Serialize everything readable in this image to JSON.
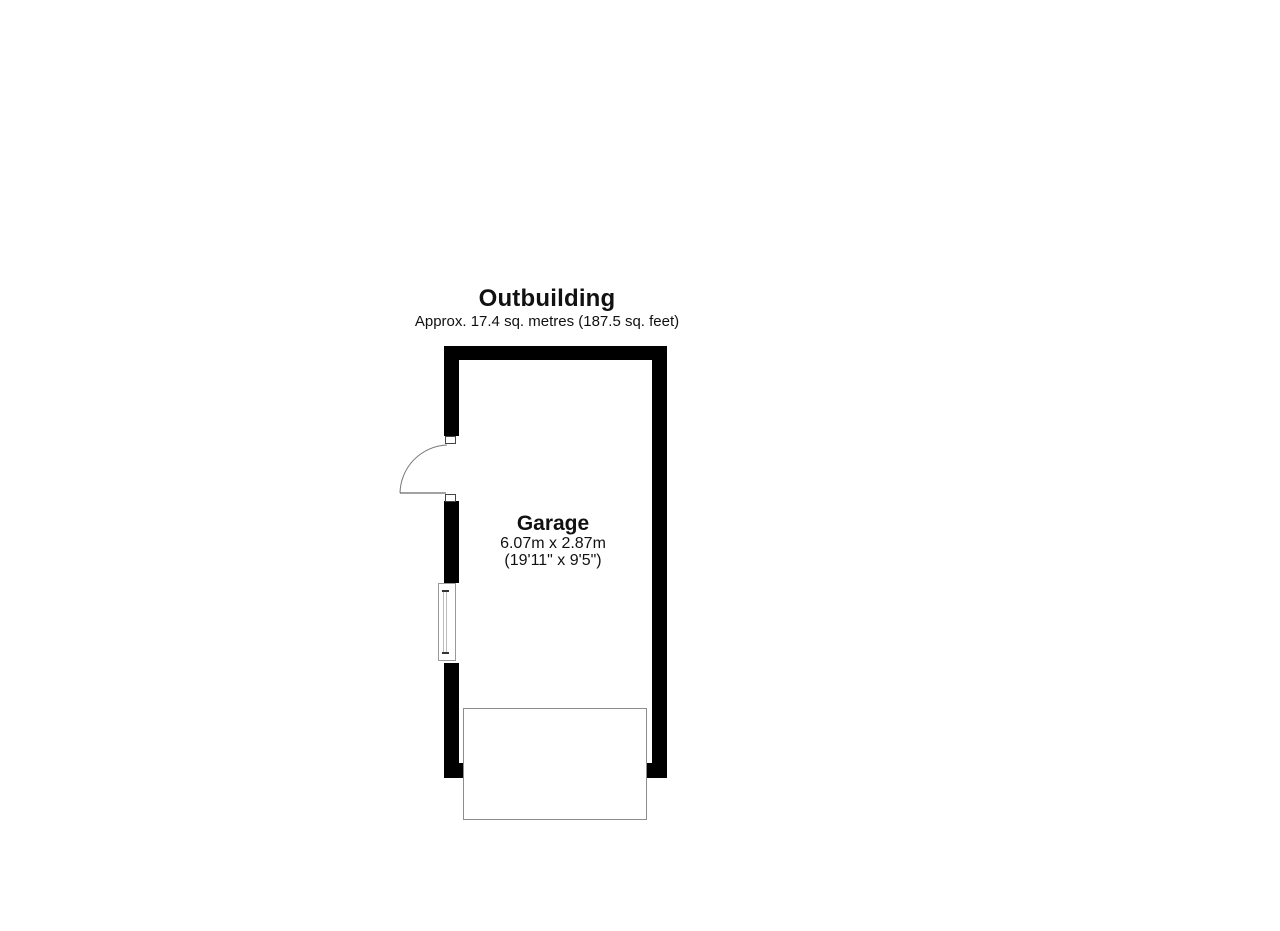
{
  "floorplan": {
    "title": "Outbuilding",
    "subtitle": "Approx. 17.4 sq. metres (187.5 sq. feet)",
    "room": {
      "name": "Garage",
      "dimensions_metric": "6.07m x 2.87m",
      "dimensions_imperial": "(19'11\" x 9'5\")"
    },
    "colors": {
      "wall": "#000000",
      "outline": "#999999",
      "background": "#ffffff"
    }
  }
}
